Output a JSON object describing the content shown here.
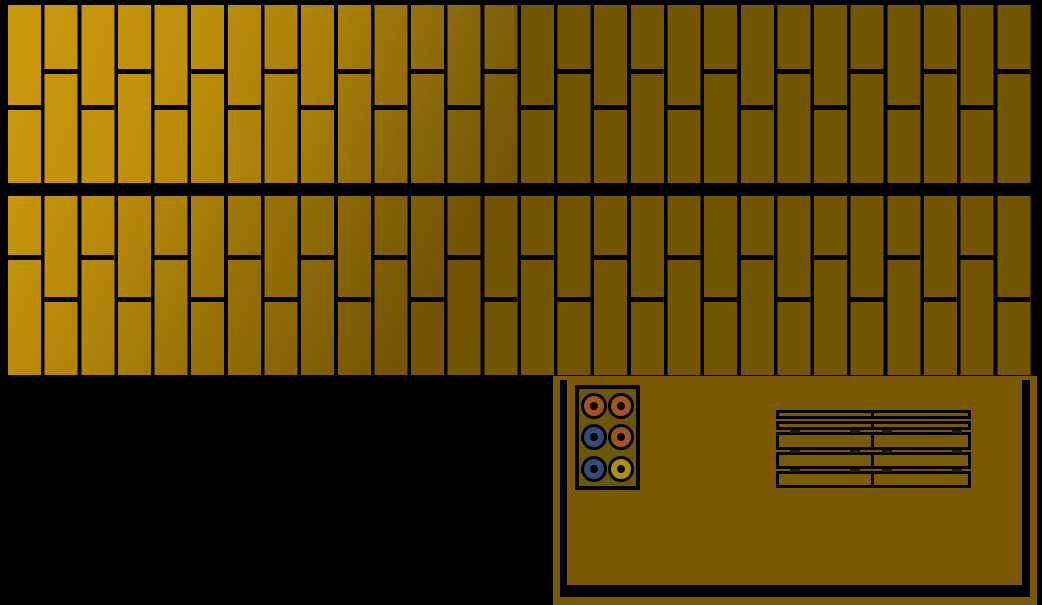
{
  "palette": {
    "bg-black": "#000000",
    "gap-black": "#000000",
    "wall-flat": "#745504",
    "table-brown": "#7a5804",
    "tray-olive": "#6b5806",
    "slat-brown": "#7a5a05",
    "tick-dark": "#241c00",
    "token-orange": "#a6541f",
    "token-blue": "#2e4d7b",
    "token-yellow": "#ab910c"
  },
  "plank_walls": {
    "column_pitch": 36.64,
    "plank_width": 33,
    "joint_height": 4.5,
    "lit_width": 506,
    "flat_color": "#745504",
    "gap_color": "#000000",
    "bands": [
      {
        "name": "upper-plank-band",
        "x": 8,
        "y": 5,
        "width": 1026,
        "height": 178,
        "joint_even_y": 100,
        "joint_odd_y": 64,
        "lighting": "linear-gradient(112deg, #cc980c 0%, #c0910b 30%, #aa7f08 58%, #86650a 82%, #745504 100%)"
      },
      {
        "name": "lower-plank-band",
        "x": 8,
        "y": 196,
        "width": 1026,
        "height": 179,
        "joint_even_y": 59,
        "joint_odd_y": 101,
        "lighting": "linear-gradient(117deg, #c9960b 0%, #b2850a 25%, #926d06 50%, #755505 78%, #745504 100%)"
      }
    ]
  },
  "table": {
    "rim_color": "#7a5804",
    "surface_color": "#7a5804",
    "tray": {
      "background": "#6b5806",
      "tokens": [
        [
          "token-orange",
          "token-orange"
        ],
        [
          "token-blue",
          "token-orange"
        ],
        [
          "token-blue",
          "token-yellow"
        ]
      ]
    },
    "slats": {
      "cell_color": "#7a5a05",
      "left_cell_width": 98,
      "rows": [
        {
          "y": 0,
          "h": 9,
          "kind": "thin"
        },
        {
          "y": 11,
          "h": 9,
          "kind": "thin"
        },
        {
          "y": 22,
          "h": 18,
          "kind": "thick"
        },
        {
          "y": 42,
          "h": 17,
          "kind": "thick"
        },
        {
          "y": 61,
          "h": 17,
          "kind": "thick"
        }
      ],
      "ticks": {
        "color": "#241c00",
        "y_positions": [
          19.5,
          39.5,
          58.5
        ],
        "x_positions": [
          14,
          74,
          106,
          176
        ]
      }
    }
  }
}
